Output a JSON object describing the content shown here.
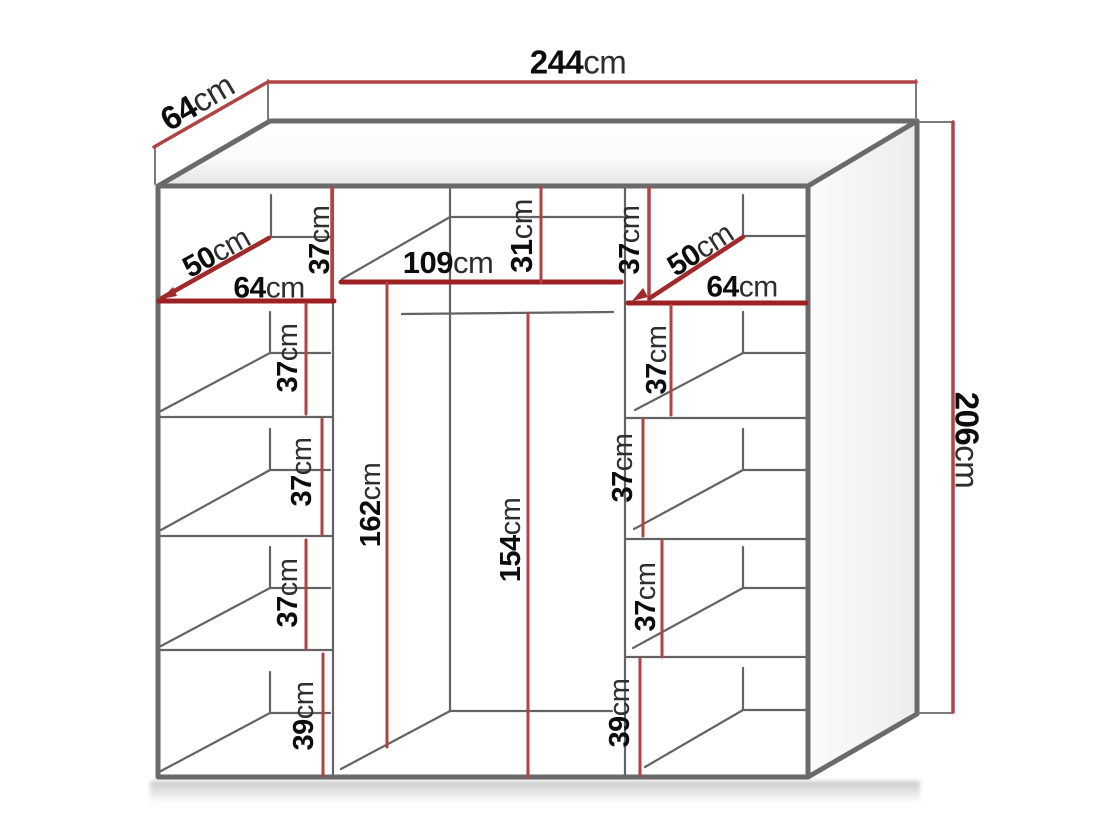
{
  "diagram_title": "wardrobe-dimension-diagram",
  "unit_suffix": "cm",
  "colors": {
    "dimension_line_red": "#b04343",
    "shelf_highlight_red": "#9d2123",
    "structure_grey": "#6a6a6a",
    "label_number_black": "#0d0d0d",
    "label_unit_black": "#2e2e2e"
  },
  "overall": {
    "width": {
      "num": "244",
      "unit": "cm"
    },
    "depth": {
      "num": "64",
      "unit": "cm"
    },
    "height": {
      "num": "206",
      "unit": "cm"
    }
  },
  "middle_section": {
    "top_shelf_width": {
      "num": "109",
      "unit": "cm"
    },
    "top_section_height": {
      "num": "31",
      "unit": "cm"
    },
    "interior_height_rear": {
      "num": "162",
      "unit": "cm"
    },
    "interior_height_front": {
      "num": "154",
      "unit": "cm"
    }
  },
  "left_column": {
    "corner_shelf_diagonal": {
      "num": "50",
      "unit": "cm"
    },
    "shelf_width": {
      "num": "64",
      "unit": "cm"
    },
    "sections": [
      {
        "num": "37",
        "unit": "cm"
      },
      {
        "num": "37",
        "unit": "cm"
      },
      {
        "num": "37",
        "unit": "cm"
      },
      {
        "num": "37",
        "unit": "cm"
      },
      {
        "num": "39",
        "unit": "cm"
      }
    ]
  },
  "right_column": {
    "corner_shelf_diagonal": {
      "num": "50",
      "unit": "cm"
    },
    "shelf_width": {
      "num": "64",
      "unit": "cm"
    },
    "sections": [
      {
        "num": "37",
        "unit": "cm"
      },
      {
        "num": "37",
        "unit": "cm"
      },
      {
        "num": "37",
        "unit": "cm"
      },
      {
        "num": "37",
        "unit": "cm"
      },
      {
        "num": "39",
        "unit": "cm"
      }
    ]
  }
}
